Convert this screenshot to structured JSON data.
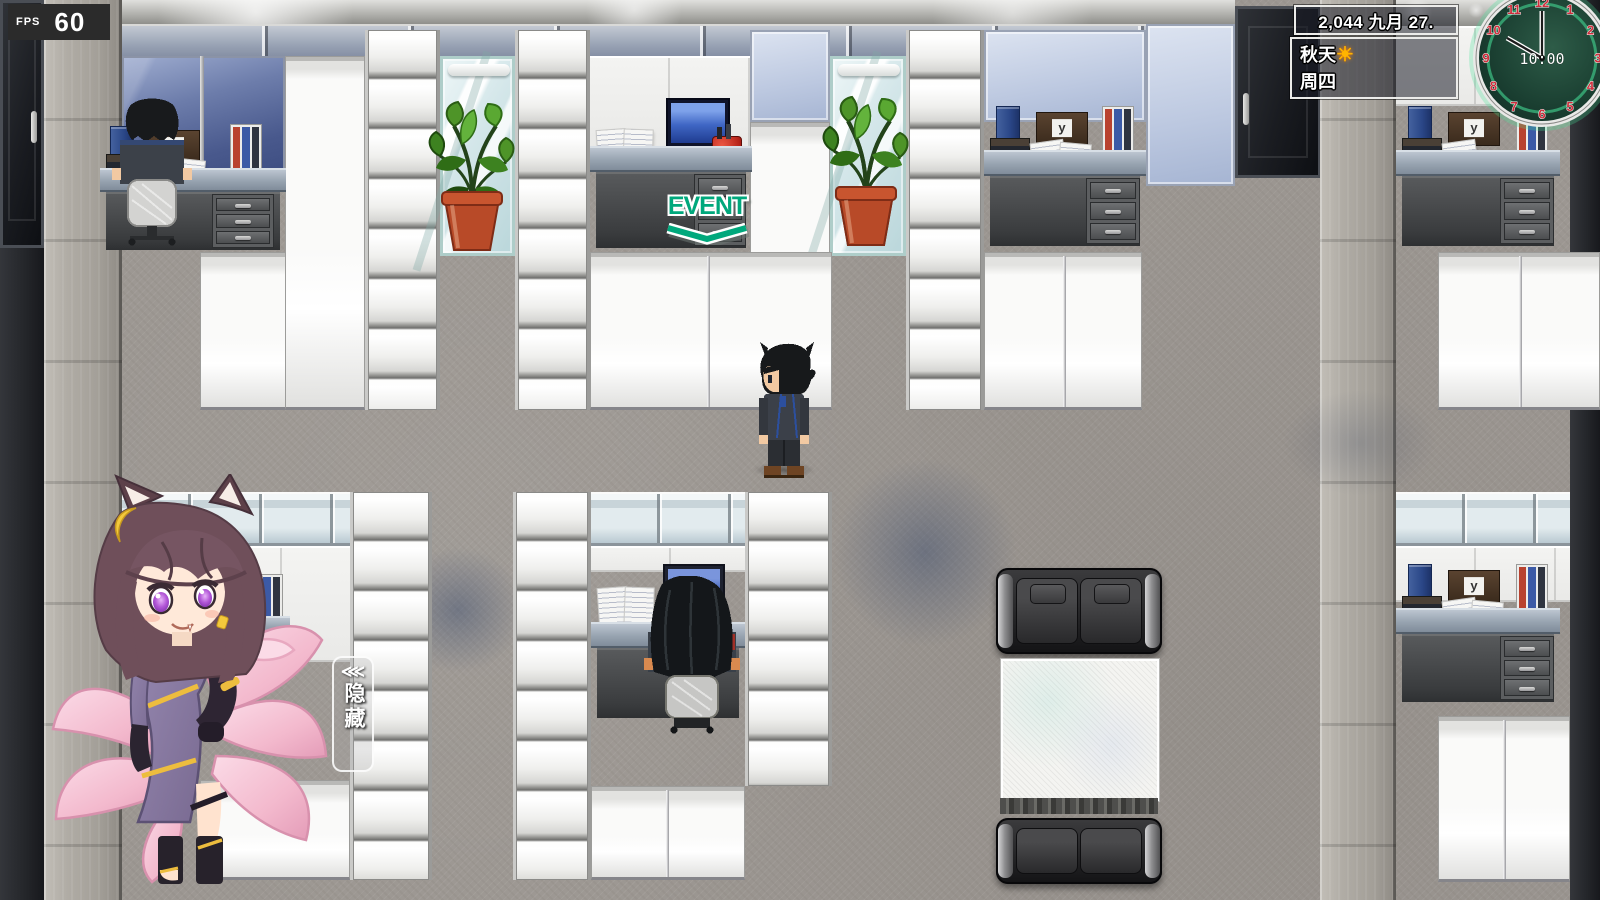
{
  "hud": {
    "fps": {
      "label": "FPS",
      "value": "60"
    },
    "calendar": {
      "date": "2,044 九月 27."
    },
    "weather": {
      "season": "秋天",
      "sun_icon": "☀",
      "weekday": "周四"
    },
    "clock": {
      "time": "10:00",
      "numbers": [
        "12",
        "1",
        "2",
        "3",
        "4",
        "5",
        "6",
        "7",
        "8",
        "9",
        "10",
        "11"
      ],
      "hour_hand_angle_deg": 300,
      "minute_hand_angle_deg": 0
    },
    "event_marker": {
      "label": "EVENT"
    },
    "hide_button": {
      "arrows": "⋘",
      "label": "隐藏"
    }
  },
  "colors": {
    "event_green": "#00a87c",
    "clock_number_red": "#cc2f3c",
    "clock_face_green": "#16342a",
    "sun_yellow": "#ffb400",
    "fox_tail_pink": "#f3b9cd",
    "floor_gray": "#9c9792",
    "hud_box_border": "#ececea"
  }
}
